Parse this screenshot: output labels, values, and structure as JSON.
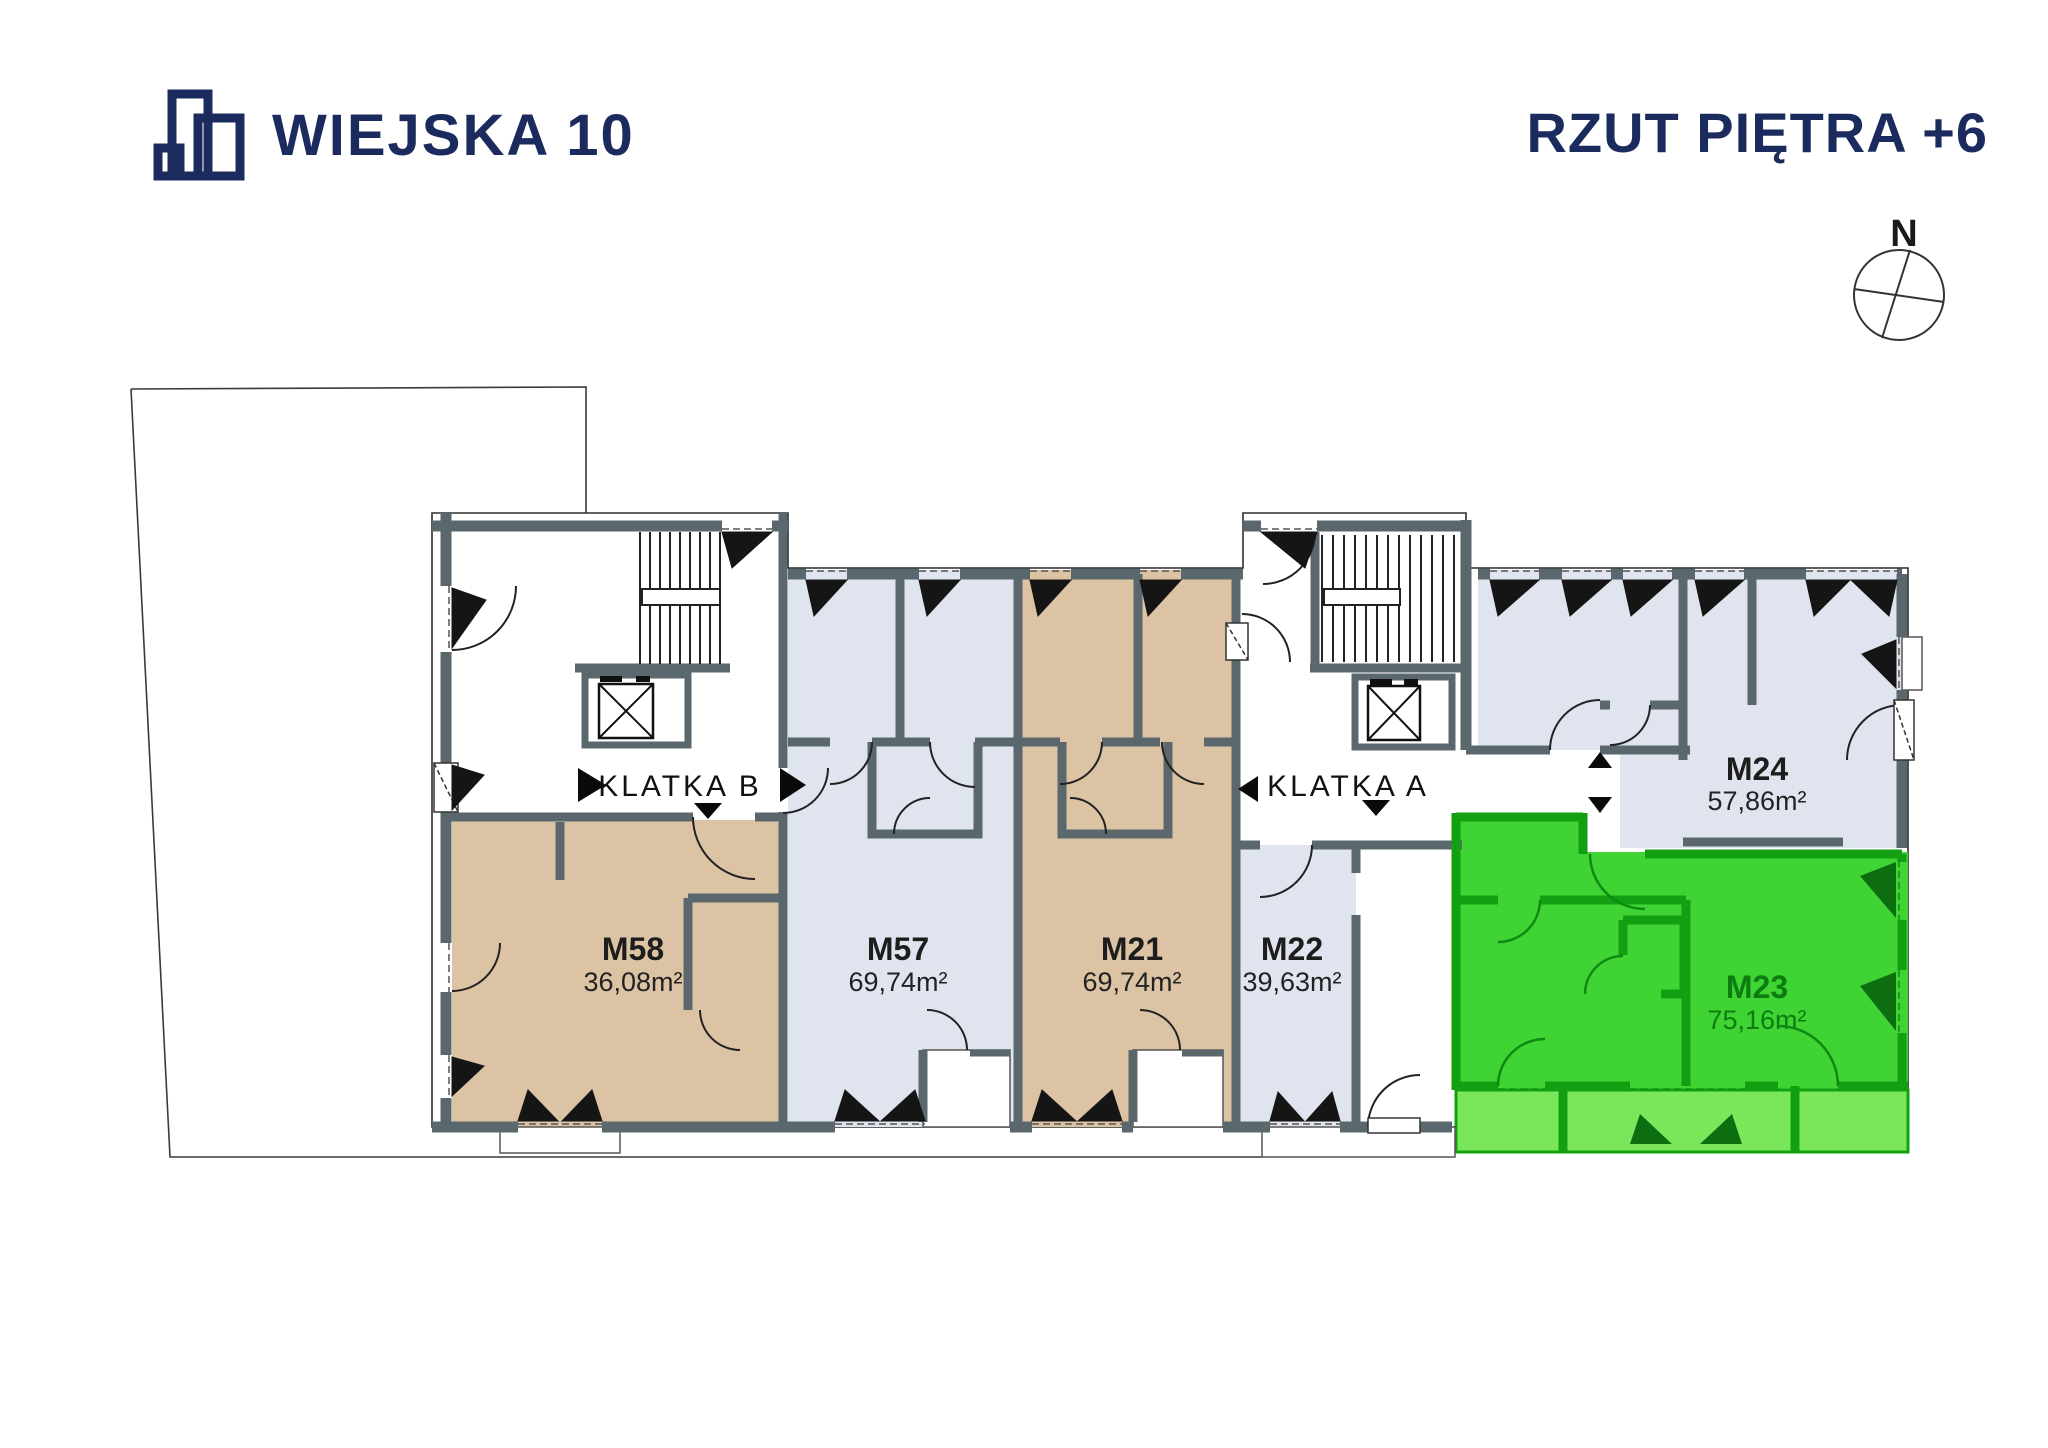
{
  "header": {
    "logo_text": "WIEJSKA 10",
    "title": "RZUT PIĘTRA +6"
  },
  "compass": {
    "north_label": "N"
  },
  "staircases": [
    {
      "label": "KLATKA B"
    },
    {
      "label": "KLATKA A"
    }
  ],
  "apartments": [
    {
      "id": "M58",
      "area": "36,08m²",
      "fill": "#dcc3a3",
      "highlighted": false
    },
    {
      "id": "M57",
      "area": "69,74m²",
      "fill": "#e0e4ee",
      "highlighted": false
    },
    {
      "id": "M21",
      "area": "69,74m²",
      "fill": "#dcc3a3",
      "highlighted": false
    },
    {
      "id": "M22",
      "area": "39,63m²",
      "fill": "#e0e4ee",
      "highlighted": false
    },
    {
      "id": "M24",
      "area": "57,86m²",
      "fill": "#e0e4ee",
      "highlighted": false
    },
    {
      "id": "M23",
      "area": "75,16m²",
      "fill": "#3fd334",
      "highlighted": true
    }
  ],
  "colors": {
    "brand_navy": "#1c2b5e",
    "wall": "#5a686d",
    "apartment_tan": "#dcc3a3",
    "apartment_gray": "#e0e4ee",
    "highlight_green": "#3fd334",
    "highlight_green_light": "#7ae75a",
    "highlight_green_wall": "#12a012",
    "highlight_green_text": "#0c7d10",
    "plan_line": "#222222"
  }
}
